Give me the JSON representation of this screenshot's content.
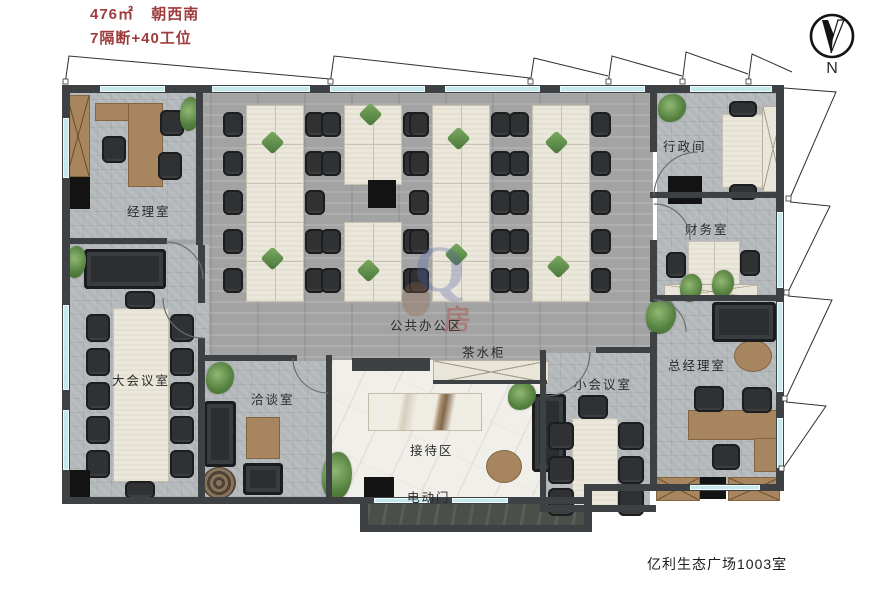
{
  "header": {
    "line1_area": "476㎡",
    "line1_facing": "朝西南",
    "line2": "7隔断+40工位",
    "text_color": "#9e3c3d"
  },
  "compass": {
    "north": "N"
  },
  "rooms": {
    "manager_office": {
      "label": "经理室"
    },
    "admin_room": {
      "label": "行政间"
    },
    "finance_room": {
      "label": "财务室"
    },
    "open_office": {
      "label": "公共办公区"
    },
    "tea_cabinet": {
      "label": "茶水柜"
    },
    "large_meeting_room": {
      "label": "大会议室"
    },
    "negotiation_room": {
      "label": "洽谈室"
    },
    "reception": {
      "label": "接待区"
    },
    "small_meeting_room": {
      "label": "小会议室"
    },
    "gm_office": {
      "label": "总经理室"
    },
    "electric_door": {
      "label": "电动门"
    }
  },
  "footer": {
    "address": "亿利生态广场1003室"
  },
  "watermark": {
    "logo": "Q",
    "text": "房"
  },
  "palette": {
    "wall": "#3e4143",
    "window": "#c3e9ec",
    "accent_red": "#9e3c3d"
  }
}
